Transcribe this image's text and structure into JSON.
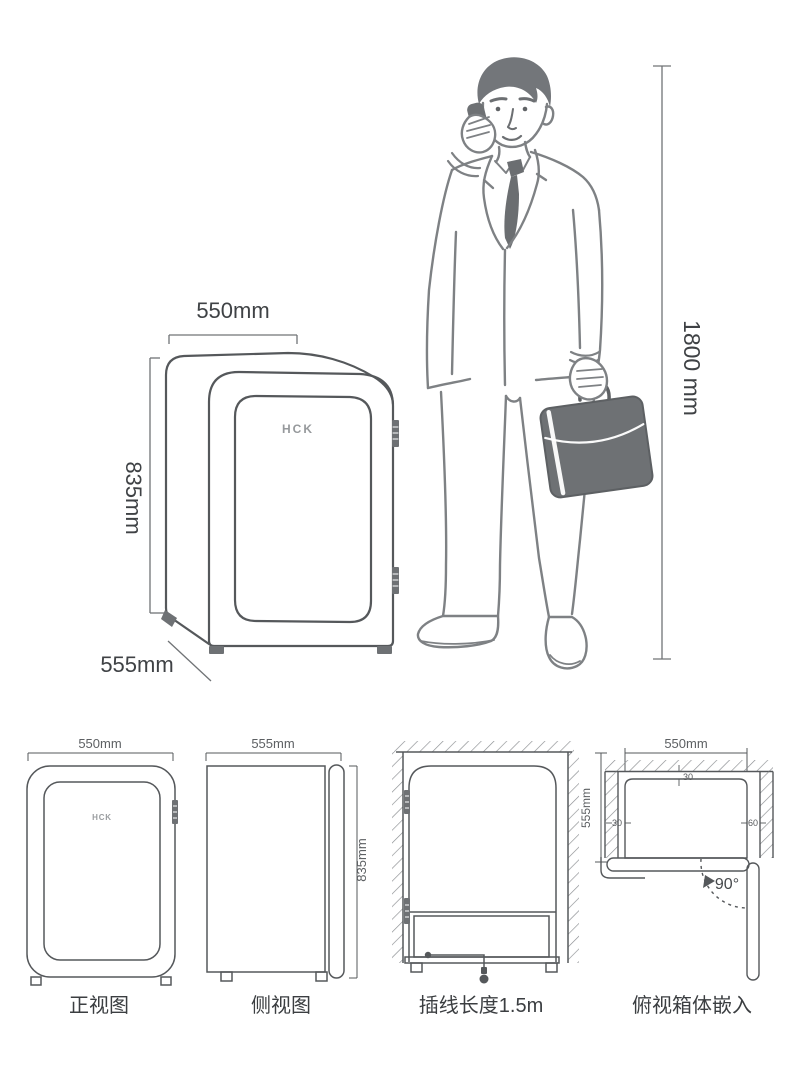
{
  "colors": {
    "line_dark": "#55585b",
    "line_person": "#7e8184",
    "dim_line": "#707376",
    "fill_dark": "#6e7174",
    "text_dark": "#3f4245",
    "hatch": "#8a8d90"
  },
  "main": {
    "brand": "HCK",
    "dim_width": "550mm",
    "dim_height": "835mm",
    "dim_depth": "555mm",
    "person_height": "1800 mm"
  },
  "views": {
    "front": {
      "caption": "正视图",
      "dim_width": "550mm",
      "brand": "HCK"
    },
    "side": {
      "caption": "侧视图",
      "dim_depth": "555mm",
      "dim_height": "835mm"
    },
    "cord": {
      "caption": "插线长度1.5m"
    },
    "top": {
      "caption": "俯视箱体嵌入",
      "dim_width": "550mm",
      "dim_depth": "555mm",
      "gap_back": "30",
      "gap_left": "30",
      "gap_right": "60",
      "door_angle": "90°"
    }
  }
}
